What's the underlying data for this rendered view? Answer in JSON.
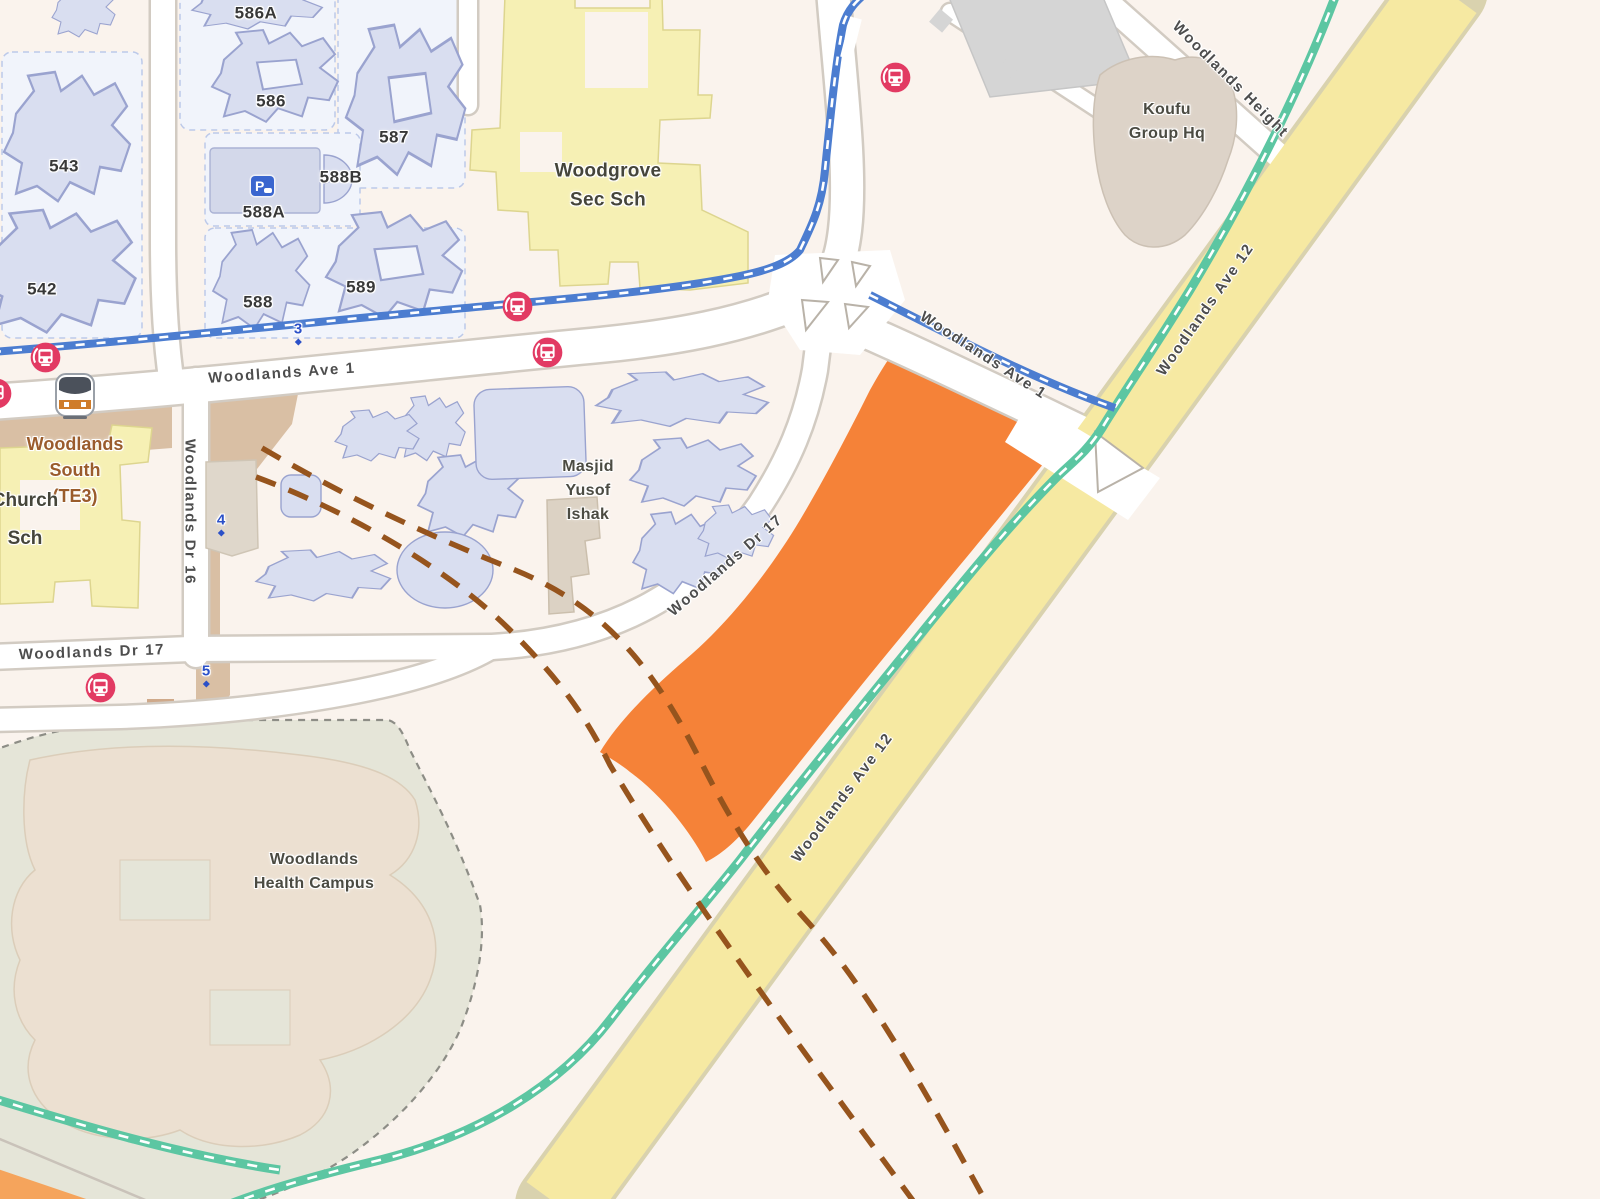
{
  "map": {
    "title": "Woodlands area street map with highlighted land parcel",
    "road_labels": {
      "ave1_west": "Woodlands Ave 1",
      "ave1_southeast": "Woodlands Ave 1",
      "ave12_upper": "Woodlands Ave 12",
      "ave12_lower": "Woodlands Ave 12",
      "woodlands_height": "Woodlands Height",
      "dr16": "Woodlands Dr 16",
      "dr17_west": "Woodlands Dr 17",
      "dr17_curve": "Woodlands Dr 17"
    },
    "place_labels": {
      "woodgrove": "Woodgrove\nSec Sch",
      "masjid": "Masjid\nYusof\nIshak",
      "koufu": "Koufu\nGroup Hq",
      "health_campus": "Woodlands\nHealth Campus",
      "station": "Woodlands\nSouth\n(TE3)",
      "church": "Church\nSch"
    },
    "block_labels": {
      "b543": "543",
      "b542": "542",
      "b586a": "586A",
      "b586": "586",
      "b587": "587",
      "b588a": "588A",
      "b588b": "588B",
      "b588": "588",
      "b589": "589"
    },
    "exit_labels": {
      "e3": "3",
      "e4": "4",
      "e5": "5"
    },
    "parking_label": "P",
    "icons": [
      "bus-stop-icon",
      "mrt-station-icon",
      "parking-icon",
      "exit-number-badge"
    ],
    "colors": {
      "background": "#faf3ed",
      "highlight_parcel": "#f58238",
      "major_road_yellow": "#f6e9a2",
      "cycling_path_blue": "#4c7dd0",
      "park_connector_green": "#5cc6a2",
      "rail_tunnel_brown": "#96541d",
      "bus_stop_red": "#e23a63",
      "building_fill": "#d9def0",
      "school_fill": "#f6f0b4",
      "station_area_tan": "#d9bfa4",
      "health_campus_fill": "#e5e5d8",
      "road_label_text": "#4d4d4d",
      "station_label_text": "#9a5c2c",
      "exit_label_text": "#2b50c8"
    }
  }
}
